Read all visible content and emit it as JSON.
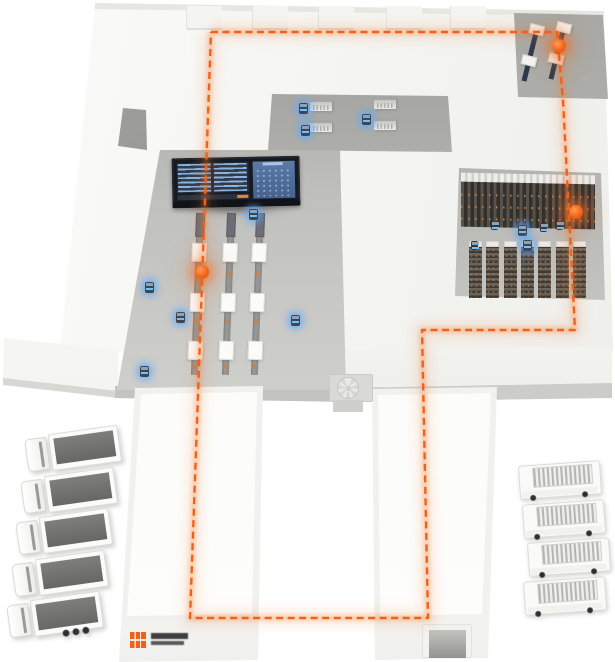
{
  "meta": {
    "description": "Isometric 3D rendering of a smart logistics warehouse: orange AGV route loop, control dashboard screen, three conveyor production lines, dark storage racks, two loading wings, semi-trailer trucks on the left and box vans on the right",
    "background": "#ffffff"
  },
  "palette": {
    "accent_orange": "#f2611a",
    "route_glow": "rgba(246,120,40,0.30)",
    "roof_white": "#f5f5f2",
    "recess_gray": "#c1c1be",
    "rack_dark": "#332f2a",
    "screen_panel_blue": "#5a7aa8",
    "agv_glow_blue": "#5aabff",
    "trailer_top_gray": "#6f6f6d"
  },
  "route": {
    "style": "dashed",
    "color": "#f2611a",
    "points": "211,32 557,32 563,100 575,330 422,330 428,618 190,618 211,32",
    "markers": [
      {
        "name": "marker-dock-machines",
        "x": 559,
        "y": 46
      },
      {
        "name": "marker-storage-bay",
        "x": 576,
        "y": 212
      },
      {
        "name": "marker-production-line",
        "x": 202,
        "y": 272
      }
    ]
  },
  "zones": [
    {
      "name": "dock-machines-bay"
    },
    {
      "name": "workstation-courtyard"
    },
    {
      "name": "production-hall"
    },
    {
      "name": "storage-bay"
    },
    {
      "name": "left-loading-wing"
    },
    {
      "name": "right-loading-wing"
    }
  ],
  "dashboard": {
    "left_panel": "text-rows",
    "right_panel": "facility-map",
    "accent": "#e8872f"
  },
  "roof": {
    "vents_x": [
      186,
      252,
      318,
      386,
      450
    ]
  },
  "conveyors": {
    "count": 3,
    "lines": [
      {
        "x": 190,
        "y": 213
      },
      {
        "x": 221,
        "y": 213
      },
      {
        "x": 250,
        "y": 213
      }
    ],
    "box_offsets": [
      30,
      80,
      128
    ],
    "dot_offsets": [
      58,
      106,
      152
    ]
  },
  "storage": {
    "floor_rack_count": 7,
    "floor_rack_start_x": 469,
    "floor_rack_y": 241,
    "floor_rack_gap": 17.3,
    "orange_row_offsets": [
      12,
      24,
      36
    ]
  },
  "workstations": {
    "desks": [
      {
        "x": 310,
        "y": 100
      },
      {
        "x": 310,
        "y": 121
      },
      {
        "x": 374,
        "y": 98
      },
      {
        "x": 374,
        "y": 119
      }
    ]
  },
  "machines": {
    "units": [
      {
        "x": 522,
        "y": 24
      },
      {
        "x": 549,
        "y": 22
      }
    ]
  },
  "agvs": {
    "hall": [
      {
        "x": 249,
        "y": 209
      },
      {
        "x": 145,
        "y": 282
      },
      {
        "x": 140,
        "y": 366
      },
      {
        "x": 176,
        "y": 312
      },
      {
        "x": 291,
        "y": 315
      }
    ],
    "courtyard": [
      {
        "x": 299,
        "y": 103
      },
      {
        "x": 301,
        "y": 125
      },
      {
        "x": 362,
        "y": 114
      }
    ],
    "storage": [
      {
        "x": 491,
        "y": 221,
        "dim": true
      },
      {
        "x": 518,
        "y": 225
      },
      {
        "x": 540,
        "y": 223,
        "dim": true
      },
      {
        "x": 556,
        "y": 221,
        "dim": true
      },
      {
        "x": 471,
        "y": 241,
        "dim": true
      },
      {
        "x": 523,
        "y": 240
      }
    ]
  },
  "trucks": {
    "left": {
      "count": 5,
      "type": "semi-trailer",
      "start_x": 26,
      "start_y": 431,
      "dx": -4.5,
      "dy": 41.5
    },
    "right": {
      "count": 4,
      "type": "box-van",
      "start_y": 463,
      "dy": 38.5,
      "x_offsets": [
        519,
        523,
        528,
        524
      ]
    }
  },
  "logo": {
    "shape": "orange-square",
    "color": "#f2611a",
    "text_legible": false
  }
}
